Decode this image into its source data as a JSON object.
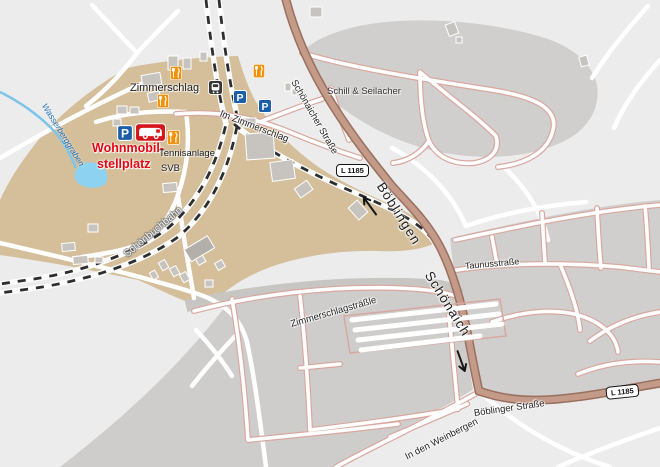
{
  "map": {
    "colors": {
      "background": "#ececec",
      "site_area": "#d4bf9a",
      "built_area": "#d1cfce",
      "allotment_area": "#cfcdcc",
      "main_road_fill": "#c49a89",
      "main_road_casing": "#9a6f5f",
      "minor_road_casing": "#d8a89f",
      "railway": "#2e2e2e",
      "water": "#7cc4ea",
      "parking_blue": "#1b5fa9",
      "restaurant_orange": "#f29007",
      "rv_red": "#d4161c",
      "label_red": "#e30613",
      "water_label_blue": "#1d6cb5"
    },
    "labels": [
      {
        "name": "place-label-zimmerschlag",
        "text": "Zimmerschlag",
        "x": 130,
        "y": 83,
        "rot": 0,
        "style": "place-name"
      },
      {
        "name": "street-label-im-zimmerschlag",
        "text": "Im Zimmerschlag",
        "x": 220,
        "y": 109,
        "rot": 21,
        "style": "street"
      },
      {
        "name": "street-label-schoenaicher-strasse",
        "text": "Schönaicher Straße",
        "x": 293,
        "y": 76,
        "rot": 60,
        "style": "street"
      },
      {
        "name": "place-label-schill-seilacher",
        "text": "Schill & Seilacher",
        "x": 327,
        "y": 87,
        "rot": 0,
        "style": "place"
      },
      {
        "name": "dest-label-boeblingen",
        "text": "Böblingen",
        "x": 380,
        "y": 177,
        "rot": 58,
        "style": "dest"
      },
      {
        "name": "dest-label-schoenaich",
        "text": "Schönaich",
        "x": 428,
        "y": 266,
        "rot": 58,
        "style": "dest"
      },
      {
        "name": "street-label-taunusstrasse",
        "text": "Taunusstraße",
        "x": 465,
        "y": 262,
        "rot": -5,
        "style": "street-sm"
      },
      {
        "name": "street-label-zimmerschlagstraessle",
        "text": "Zimmerschlagsträßle",
        "x": 291,
        "y": 320,
        "rot": -16,
        "style": "street"
      },
      {
        "name": "street-label-boeblinger-strasse",
        "text": "Böblinger Straße",
        "x": 474,
        "y": 409,
        "rot": -8,
        "style": "street"
      },
      {
        "name": "street-label-in-den-weinbergen",
        "text": "In den Weinbergen",
        "x": 406,
        "y": 453,
        "rot": -27,
        "style": "street"
      },
      {
        "name": "railway-label-schoenbuchbahn",
        "text": "Schönbuchbahn",
        "x": 126,
        "y": 251,
        "rot": -40,
        "style": "rail-lbl"
      },
      {
        "name": "water-label-wasserberggraben",
        "text": "Wasserberggraben",
        "x": 44,
        "y": 100,
        "rot": 58,
        "style": "water-lbl"
      },
      {
        "name": "poi-label-wohnmobil",
        "text": "Wohnmobil-",
        "x": 92,
        "y": 142,
        "rot": 0,
        "style": "poi-red"
      },
      {
        "name": "poi-label-stellplatz",
        "text": "stellplatz",
        "x": 97,
        "y": 158,
        "rot": 0,
        "style": "poi-red"
      },
      {
        "name": "poi-label-tennisanlage",
        "text": "Tennisanlage",
        "x": 159,
        "y": 149,
        "rot": 0,
        "style": "poi-dark"
      },
      {
        "name": "poi-label-svb",
        "text": "SVB",
        "x": 161,
        "y": 164,
        "rot": 0,
        "style": "poi-dark"
      }
    ],
    "badges": [
      {
        "name": "road-ref-badge-l1185-top",
        "text": "L 1185",
        "x": 336,
        "y": 164,
        "rot": 0
      },
      {
        "name": "road-ref-badge-l1185-bottom",
        "text": "L 1185",
        "x": 606,
        "y": 387,
        "rot": -6
      }
    ],
    "icons": [
      {
        "name": "parking-icon",
        "type": "parking",
        "x": 233,
        "y": 90,
        "s": 14
      },
      {
        "name": "parking-icon",
        "type": "parking",
        "x": 258,
        "y": 99,
        "s": 14
      },
      {
        "name": "parking-icon",
        "type": "parking",
        "x": 117,
        "y": 125,
        "s": 16
      },
      {
        "name": "restaurant-icon",
        "type": "restaurant",
        "x": 170,
        "y": 66,
        "s": 12
      },
      {
        "name": "restaurant-icon",
        "type": "restaurant",
        "x": 253,
        "y": 64,
        "s": 12
      },
      {
        "name": "restaurant-icon",
        "type": "restaurant",
        "x": 157,
        "y": 94,
        "s": 12
      },
      {
        "name": "restaurant-icon",
        "type": "restaurant",
        "x": 167,
        "y": 130,
        "s": 13
      },
      {
        "name": "train-station-icon",
        "type": "station",
        "x": 208,
        "y": 80,
        "s": 15
      },
      {
        "name": "rv-campsite-icon",
        "type": "rv",
        "x": 135,
        "y": 123,
        "s": 31
      }
    ],
    "arrows": [
      {
        "name": "direction-arrow-boeblingen",
        "dir": "left",
        "x": 358,
        "y": 184,
        "rot": 54
      },
      {
        "name": "direction-arrow-schoenaich",
        "dir": "right",
        "x": 455,
        "y": 341,
        "rot": 70
      }
    ]
  }
}
